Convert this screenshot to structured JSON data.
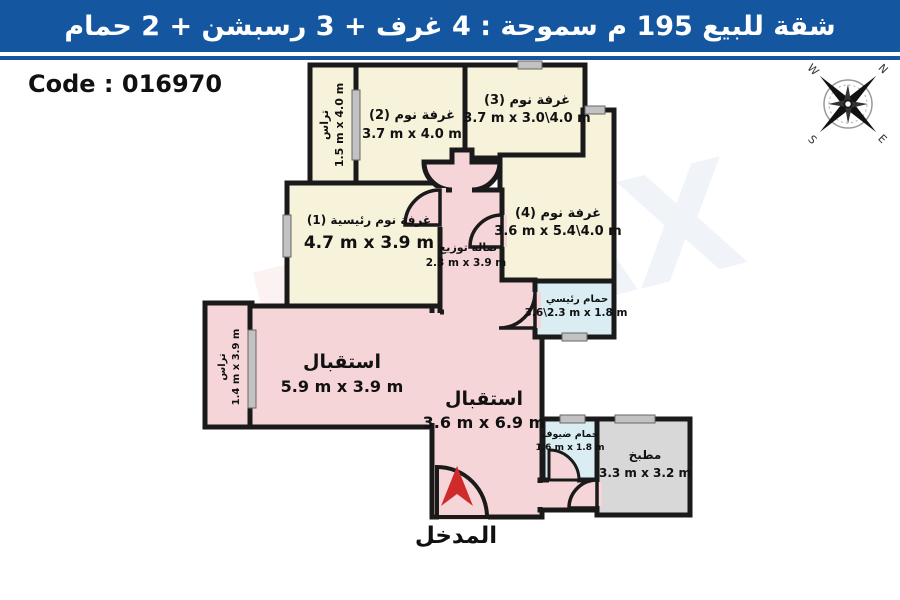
{
  "header": {
    "title": "شقة للبيع 195 م سموحة : 4 غرف + 3 رسبشن + 2 حمام"
  },
  "code_label": "Code : 016970",
  "entrance_label": "المدخل",
  "compass": {
    "n": "N",
    "e": "E",
    "s": "S",
    "w": "W"
  },
  "watermark": {
    "left": "RE",
    "right": "MAX"
  },
  "colors": {
    "header_bg": "#1456a0",
    "wall": "#1a1a1a",
    "cream": "#f7f2da",
    "pink": "#f6d5d9",
    "blue": "#d9edf2",
    "gray": "#d8d8d8",
    "window": "#c2c2c2",
    "arrow_red": "#cf2b2b"
  },
  "rooms": {
    "terrace_top": {
      "name": "تراس",
      "dims": "1.5 m x 4.0 m"
    },
    "bedroom2": {
      "name": "غرفة نوم (2)",
      "dims": "3.7 m x 4.0 m"
    },
    "bedroom3": {
      "name": "غرفة نوم (3)",
      "dims": "3.7 m x 3.0\\4.0 m"
    },
    "bedroom4": {
      "name": "غرفة نوم (4)",
      "dims": "3.6 m x 5.4\\4.0 m"
    },
    "master_bedroom": {
      "name": "غرفة نوم رئيسية (1)",
      "dims": "4.7 m x 3.9 m"
    },
    "hall": {
      "name": "صالة توزيع",
      "dims": "2.3 m x 3.9 m"
    },
    "master_bath": {
      "name": "حمام رئيسي",
      "dims": "3.6\\2.3 m x 1.8 m"
    },
    "reception1": {
      "name": "استقبال",
      "dims": "5.9 m x 3.9 m"
    },
    "reception2": {
      "name": "استقبال",
      "dims": "3.6 m x 6.9 m"
    },
    "terrace_left": {
      "name": "تراس",
      "dims": "1.4 m x 3.9 m"
    },
    "guest_bath": {
      "name": "حمام ضيوف",
      "dims": "1.6 m x 1.8 m"
    },
    "kitchen": {
      "name": "مطبخ",
      "dims": "3.3 m x 3.2 m"
    }
  }
}
